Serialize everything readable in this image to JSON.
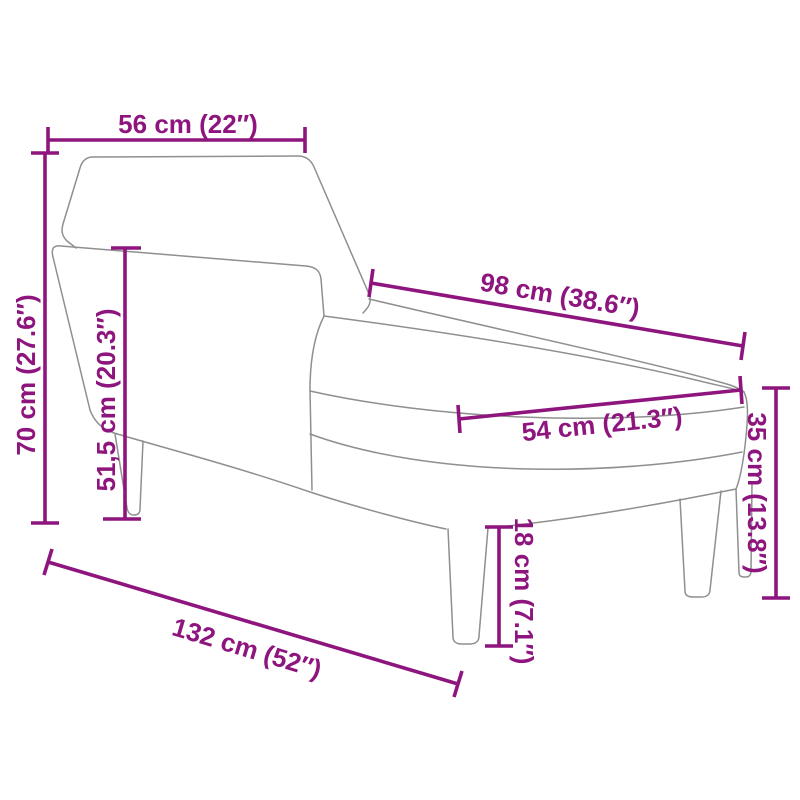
{
  "diagram": {
    "subject": "chaise-longue-line-drawing",
    "colors": {
      "dimension_accent": "#8e157e",
      "outline_gray": "#8f8f8f",
      "background": "#ffffff"
    },
    "dimensions": [
      {
        "id": "backrest-width",
        "label": "56 cm (22″)"
      },
      {
        "id": "total-height",
        "label": "70 cm (27.6″)"
      },
      {
        "id": "armrest-height",
        "label": "51,5 cm (20.3″)"
      },
      {
        "id": "seat-length",
        "label": "98 cm (38.6″)"
      },
      {
        "id": "seat-width",
        "label": "54 cm (21.3″)"
      },
      {
        "id": "seat-height",
        "label": "35 cm (13.8″)"
      },
      {
        "id": "leg-height",
        "label": "18 cm (7.1″)"
      },
      {
        "id": "total-length",
        "label": "132 cm (52″)"
      }
    ]
  }
}
